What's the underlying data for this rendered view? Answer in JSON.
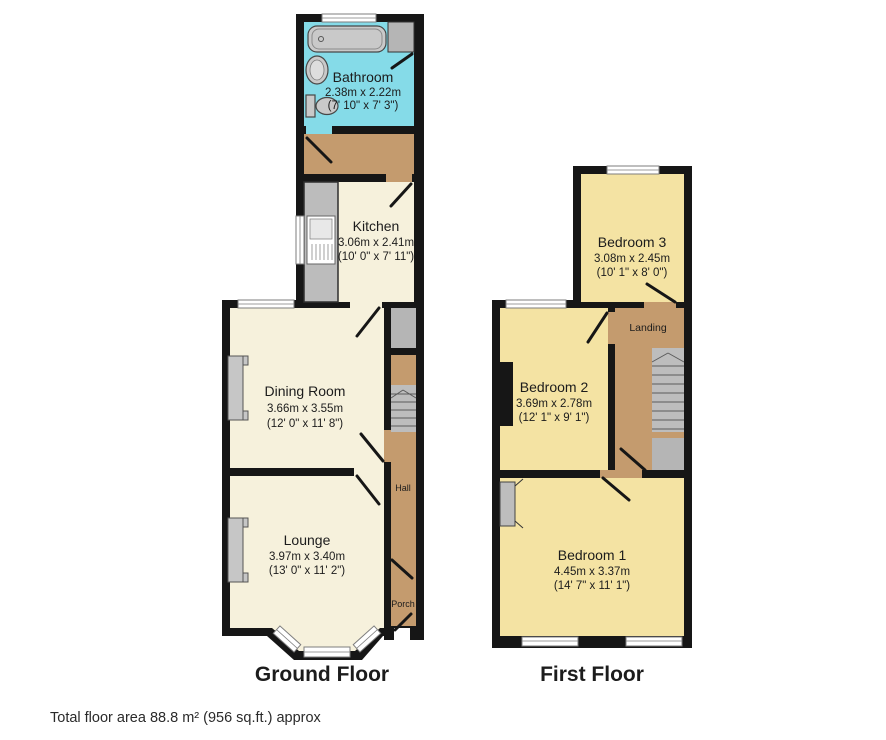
{
  "titles": {
    "ground": "Ground Floor",
    "first": "First Floor"
  },
  "footer": {
    "total_area": "Total floor area 88.8 m² (956 sq.ft.) approx"
  },
  "rooms": {
    "bathroom": {
      "name": "Bathroom",
      "metric": "2.38m x 2.22m",
      "imperial": "(7' 10\" x 7' 3\")"
    },
    "kitchen": {
      "name": "Kitchen",
      "metric": "3.06m x 2.41m",
      "imperial": "(10' 0\" x 7' 11\")"
    },
    "dining": {
      "name": "Dining Room",
      "metric": "3.66m x 3.55m",
      "imperial": "(12' 0\" x 11' 8\")"
    },
    "lounge": {
      "name": "Lounge",
      "metric": "3.97m x 3.40m",
      "imperial": "(13' 0\" x 11' 2\")"
    },
    "hall": {
      "name": "Hall"
    },
    "porch": {
      "name": "Porch"
    },
    "bedroom3": {
      "name": "Bedroom 3",
      "metric": "3.08m x 2.45m",
      "imperial": "(10' 1\" x 8' 0\")"
    },
    "bedroom2": {
      "name": "Bedroom 2",
      "metric": "3.69m x 2.78m",
      "imperial": "(12' 1\" x 9' 1\")"
    },
    "landing": {
      "name": "Landing"
    },
    "bedroom1": {
      "name": "Bedroom 1",
      "metric": "4.45m x 3.37m",
      "imperial": "(14' 7\" x 11' 1\")"
    }
  },
  "colors": {
    "wall": "#161616",
    "bathroom_floor": "#85dbe8",
    "living_floor": "#f6f1dc",
    "hall_floor": "#c49b6e",
    "bedroom_floor": "#f4e3a3",
    "fixture_gray": "#c9c9c9",
    "stair_gray": "#bdbdbd"
  }
}
